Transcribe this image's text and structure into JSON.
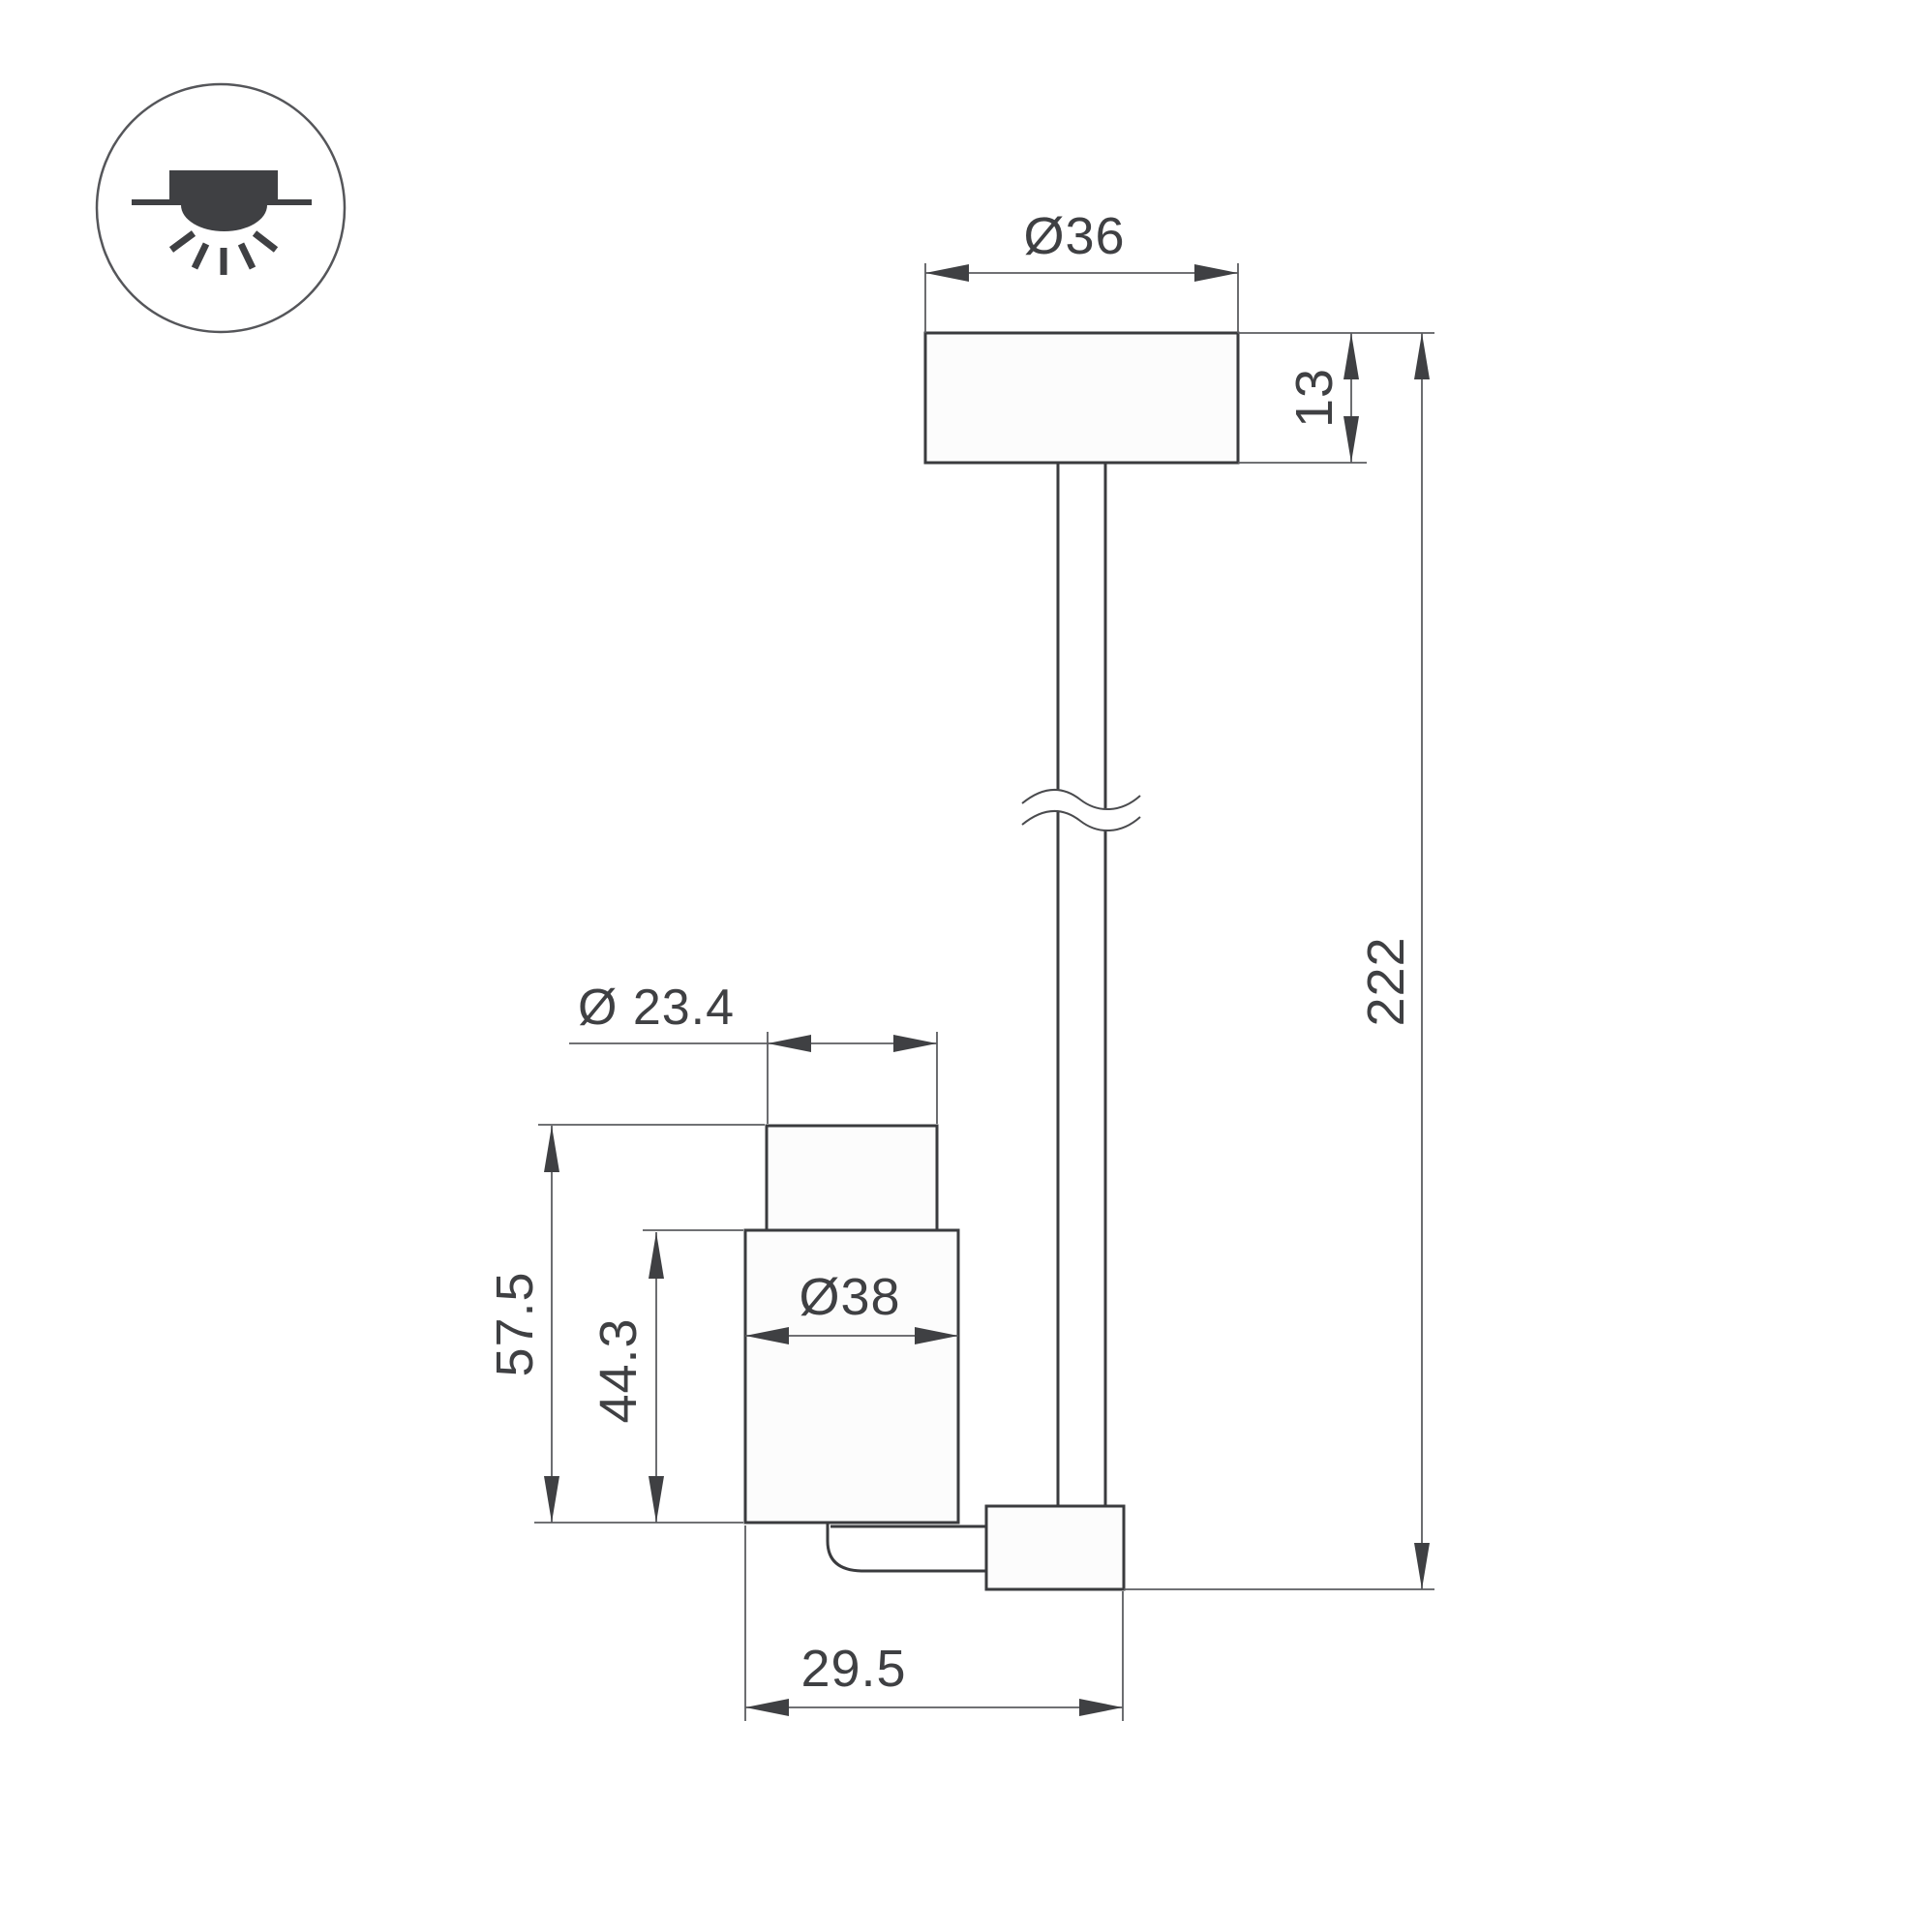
{
  "page": {
    "type": "technical-dimension-drawing",
    "background": "#ffffff"
  },
  "icon": {
    "name": "recessed-downlight-mount-icon",
    "shape": "circle with recessed ceiling light and downward light rays"
  },
  "labels": {
    "canopy_diameter": "Ø36",
    "canopy_height": "13",
    "overall_height": "222",
    "head_top_diameter": "Ø 23.4",
    "head_height": "57.5",
    "head_body_height": "44.3",
    "head_body_diameter": "Ø38",
    "arm_offset": "29.5"
  },
  "colors": {
    "outline": "#3a3b3e",
    "dimension_line": "#5c5d61",
    "annotation": "#3f4043"
  }
}
